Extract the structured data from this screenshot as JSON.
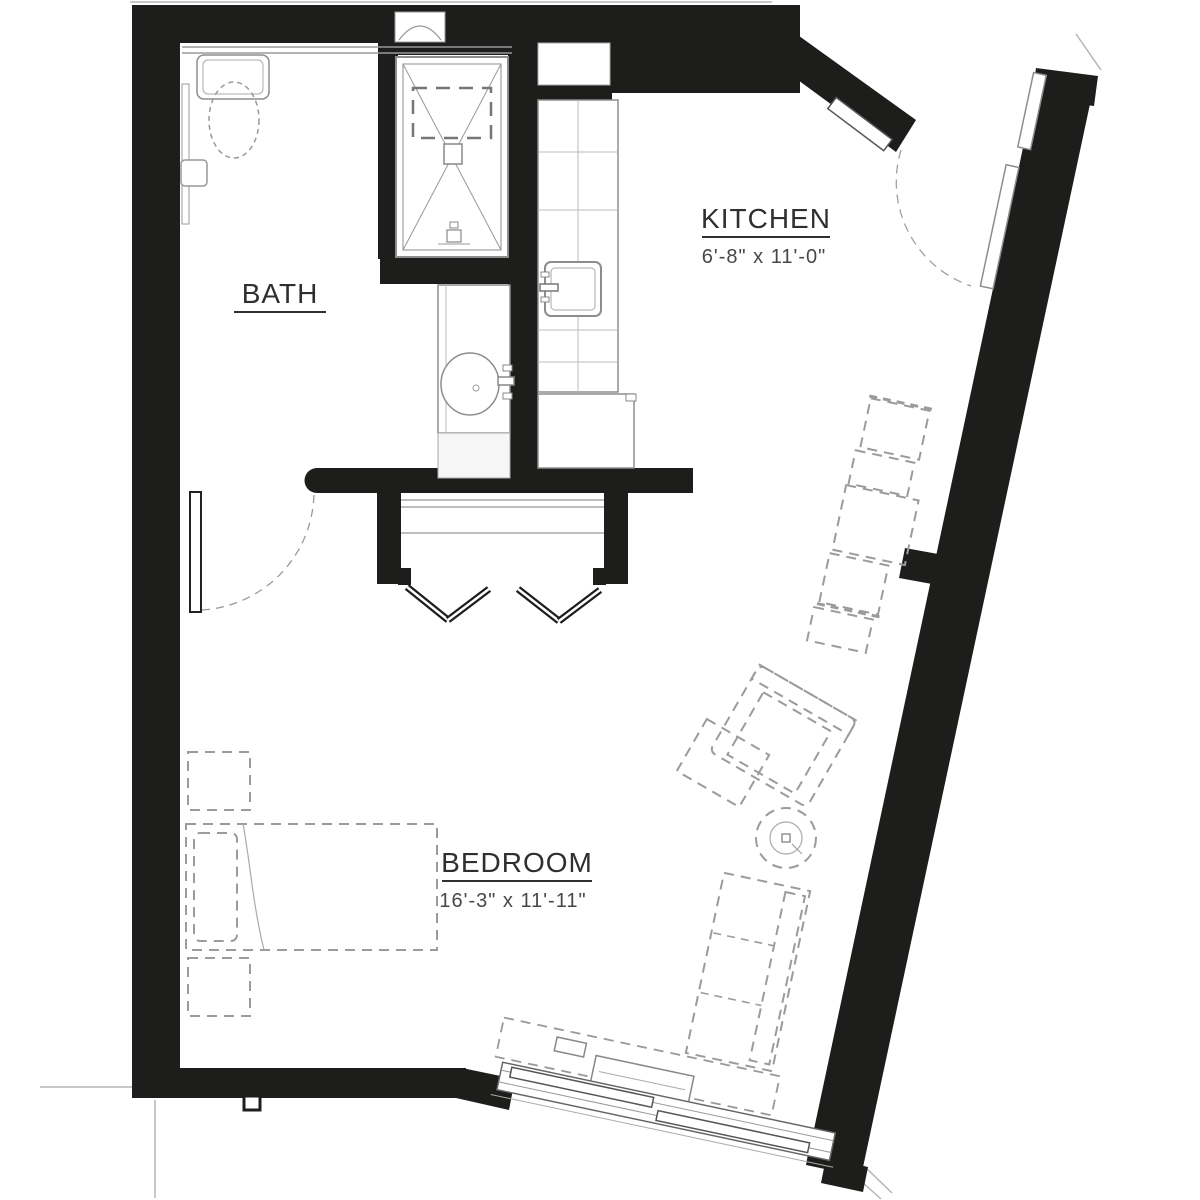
{
  "document": {
    "type": "apartment-unit-floor-plan"
  },
  "rooms": [
    {
      "id": "bath",
      "label": "BATH",
      "dims": ""
    },
    {
      "id": "kitchen",
      "label": "KITCHEN",
      "dims": "6'-8\" x 11'-0\""
    },
    {
      "id": "bedroom",
      "label": "BEDROOM",
      "dims": "16'-3\" x 11'-11\""
    }
  ],
  "fixtures": [
    {
      "name": "toilet"
    },
    {
      "name": "toilet-shelf"
    },
    {
      "name": "grab-bar"
    },
    {
      "name": "shower"
    },
    {
      "name": "shower-seat"
    },
    {
      "name": "vanity-sink"
    },
    {
      "name": "wall-niche"
    },
    {
      "name": "kitchen-counter"
    },
    {
      "name": "kitchen-sink"
    },
    {
      "name": "refrigerator"
    },
    {
      "name": "closet-shelf"
    },
    {
      "name": "bifold-closet-doors"
    },
    {
      "name": "bath-door"
    },
    {
      "name": "entry-door"
    },
    {
      "name": "right-wall-windows",
      "count": 2
    },
    {
      "name": "bottom-window"
    }
  ],
  "furniture": [
    {
      "name": "bed"
    },
    {
      "name": "pillow"
    },
    {
      "name": "nightstand",
      "count": 2
    },
    {
      "name": "dining-table"
    },
    {
      "name": "dining-chair",
      "count": 4
    },
    {
      "name": "armchair"
    },
    {
      "name": "ottoman"
    },
    {
      "name": "round-side-table"
    },
    {
      "name": "sofa"
    },
    {
      "name": "window-console"
    }
  ],
  "colors": {
    "wall": "#1d1d1b",
    "fixture_line": "#8d8d8d",
    "furniture_line": "#9b9b9b",
    "label_text": "#2f2f2f",
    "dim_text": "#474747",
    "exterior_line": "#c4c4c4",
    "background": "#ffffff"
  }
}
